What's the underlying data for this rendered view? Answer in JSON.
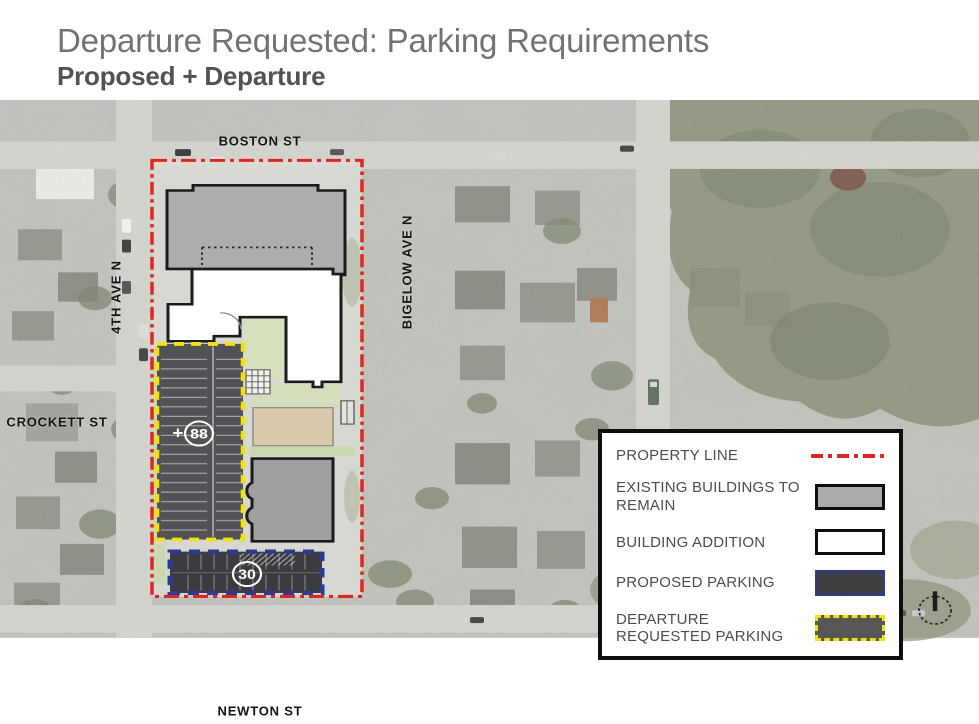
{
  "header": {
    "title": "Departure Requested: Parking Requirements",
    "subtitle": "Proposed + Departure"
  },
  "map": {
    "streets": {
      "boston": "BOSTON ST",
      "crockett": "CROCKETT ST",
      "newton": "NEWTON ST",
      "fourth_ave": "4TH AVE N",
      "bigelow": "BIGELOW AVE N"
    },
    "badges": {
      "garage_prefix": "+",
      "garage_count": "88",
      "surface_count": "30"
    }
  },
  "legend": {
    "items": [
      {
        "label": "PROPERTY LINE",
        "swatch": "property-line"
      },
      {
        "label": "EXISTING BUILDINGS TO REMAIN",
        "swatch": "existing-building"
      },
      {
        "label": "BUILDING ADDITION",
        "swatch": "building-addition"
      },
      {
        "label": "PROPOSED PARKING",
        "swatch": "proposed-parking"
      },
      {
        "label": "DEPARTURE REQUESTED PARKING",
        "swatch": "departure-parking"
      }
    ]
  },
  "colors": {
    "property_line": "#e02620",
    "departure_yellow": "#f0e20c",
    "proposed_blue": "#2b3b8f",
    "existing_gray": "#ababab",
    "parking_dark": "#525256",
    "addition_white": "#ffffff"
  }
}
